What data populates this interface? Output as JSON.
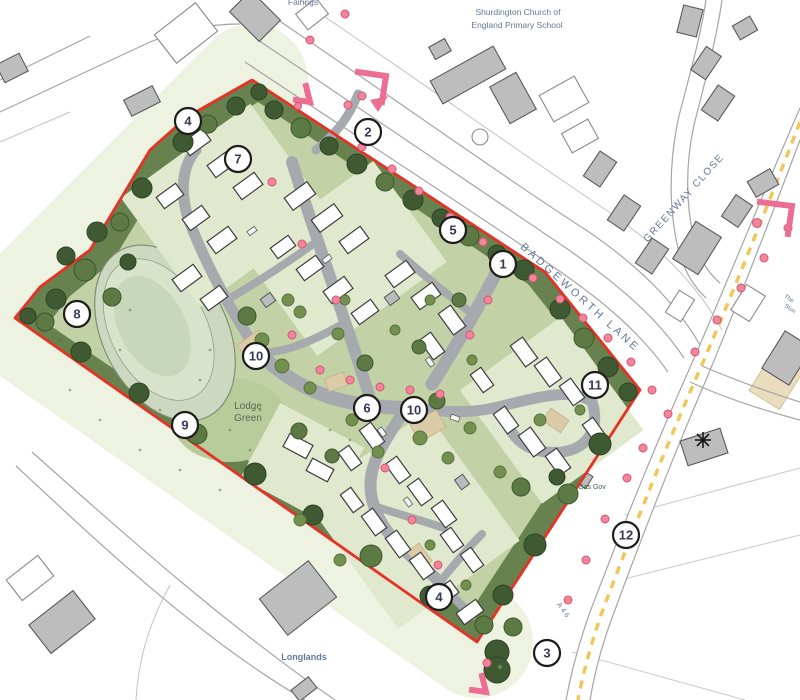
{
  "labels": {
    "school_line1": "Shurdington Church of",
    "school_line2": "England Primary School",
    "fairings": "Fairings",
    "badgeworth_lane": "BADGEWORTH LANE",
    "greenway_close": "GREENWAY CLOSE",
    "lodge_line1": "Lodge",
    "lodge_line2": "Green",
    "longlands": "Longlands",
    "gas_gov": "Gas Gov",
    "a46": "A46",
    "edge_partial_1": "The",
    "edge_partial_2": "Ston"
  },
  "colors": {
    "boundary_red": "#e63226",
    "band_green": "#67824e",
    "grass": "#c3d2a6",
    "lawn": "#b7cb9b",
    "tree_dark": "#3f5a33",
    "tree_mid": "#5d7a45",
    "tree_light": "#74904f",
    "road_gray": "#a6aaae",
    "parcel": "#e0e8cd",
    "house_stroke": "#3c3c3c",
    "building_gray": "#bdbdbd",
    "building_stroke": "#5a5a5a",
    "dot_pink": "#f2849b",
    "dot_stroke": "#d25672",
    "arrow_pink": "#ec6f93",
    "label_blue": "#64789a",
    "yellow_dash": "#f0c75a",
    "tan": "#dbcba6",
    "pond": "#ccd9c0",
    "pond_inner": "#d9e3cb",
    "wash": "#edf2e1",
    "lodge_text": "#5b6b57",
    "gas_text": "#41603f"
  },
  "markers": [
    {
      "n": "4",
      "x": 188,
      "y": 121
    },
    {
      "n": "7",
      "x": 238,
      "y": 159
    },
    {
      "n": "2",
      "x": 368,
      "y": 132
    },
    {
      "n": "5",
      "x": 453,
      "y": 230
    },
    {
      "n": "1",
      "x": 503,
      "y": 264
    },
    {
      "n": "8",
      "x": 77,
      "y": 314
    },
    {
      "n": "10",
      "x": 256,
      "y": 356
    },
    {
      "n": "6",
      "x": 367,
      "y": 408
    },
    {
      "n": "10",
      "x": 414,
      "y": 410
    },
    {
      "n": "11",
      "x": 595,
      "y": 385
    },
    {
      "n": "9",
      "x": 185,
      "y": 425
    },
    {
      "n": "12",
      "x": 626,
      "y": 535
    },
    {
      "n": "3",
      "x": 547,
      "y": 653
    },
    {
      "n": "4",
      "x": 439,
      "y": 597
    }
  ],
  "houses": [
    [
      196,
      142,
      26,
      15,
      -36
    ],
    [
      222,
      164,
      26,
      15,
      -36
    ],
    [
      248,
      186,
      26,
      15,
      -36
    ],
    [
      170,
      196,
      24,
      14,
      -36
    ],
    [
      196,
      218,
      24,
      14,
      -36
    ],
    [
      222,
      240,
      26,
      15,
      -36
    ],
    [
      187,
      278,
      26,
      15,
      -36
    ],
    [
      214,
      298,
      24,
      14,
      -36
    ],
    [
      300,
      196,
      28,
      15,
      -36
    ],
    [
      327,
      218,
      28,
      15,
      -36
    ],
    [
      354,
      240,
      26,
      15,
      -36
    ],
    [
      283,
      247,
      22,
      13,
      -36
    ],
    [
      310,
      268,
      24,
      14,
      -36
    ],
    [
      338,
      290,
      26,
      15,
      -36
    ],
    [
      365,
      312,
      24,
      14,
      -36
    ],
    [
      400,
      274,
      26,
      15,
      -36
    ],
    [
      426,
      296,
      26,
      15,
      -36
    ],
    [
      452,
      320,
      26,
      15,
      54
    ],
    [
      432,
      346,
      24,
      14,
      54
    ],
    [
      524,
      352,
      26,
      15,
      54
    ],
    [
      548,
      372,
      26,
      15,
      54
    ],
    [
      572,
      392,
      24,
      14,
      54
    ],
    [
      506,
      420,
      24,
      14,
      54
    ],
    [
      532,
      442,
      26,
      15,
      54
    ],
    [
      558,
      462,
      24,
      14,
      54
    ],
    [
      594,
      430,
      22,
      13,
      54
    ],
    [
      482,
      380,
      22,
      13,
      54
    ],
    [
      372,
      436,
      24,
      14,
      54
    ],
    [
      350,
      458,
      22,
      13,
      54
    ],
    [
      298,
      446,
      26,
      15,
      28
    ],
    [
      320,
      470,
      24,
      14,
      28
    ],
    [
      398,
      470,
      24,
      14,
      54
    ],
    [
      420,
      492,
      24,
      14,
      54
    ],
    [
      444,
      514,
      24,
      14,
      54
    ],
    [
      352,
      500,
      22,
      13,
      54
    ],
    [
      374,
      522,
      24,
      14,
      54
    ],
    [
      398,
      544,
      24,
      14,
      54
    ],
    [
      422,
      566,
      24,
      14,
      54
    ],
    [
      452,
      540,
      22,
      13,
      54
    ],
    [
      472,
      560,
      22,
      13,
      54
    ],
    [
      444,
      594,
      26,
      15,
      -36
    ],
    [
      470,
      612,
      24,
      14,
      -36
    ]
  ],
  "garages": [
    [
      268,
      300,
      12,
      10,
      -36
    ],
    [
      392,
      298,
      12,
      10,
      -36
    ],
    [
      462,
      482,
      12,
      10,
      54
    ]
  ],
  "cars": [
    [
      298,
      202,
      -36
    ],
    [
      327,
      259,
      -36
    ],
    [
      252,
      231,
      -36
    ],
    [
      430,
      362,
      54
    ],
    [
      382,
      432,
      54
    ],
    [
      408,
      502,
      54
    ],
    [
      455,
      418,
      20
    ]
  ],
  "trees": [
    [
      274,
      110,
      9,
      0
    ],
    [
      301,
      128,
      10,
      1
    ],
    [
      329,
      146,
      9,
      0
    ],
    [
      357,
      164,
      10,
      0
    ],
    [
      385,
      182,
      9,
      1
    ],
    [
      413,
      200,
      10,
      0
    ],
    [
      441,
      218,
      9,
      0
    ],
    [
      469,
      236,
      10,
      1
    ],
    [
      497,
      254,
      9,
      0
    ],
    [
      524,
      270,
      10,
      0
    ],
    [
      560,
      309,
      10,
      0
    ],
    [
      584,
      338,
      10,
      1
    ],
    [
      608,
      367,
      10,
      0
    ],
    [
      628,
      392,
      9,
      0
    ],
    [
      600,
      444,
      11,
      0
    ],
    [
      568,
      494,
      10,
      1
    ],
    [
      535,
      545,
      11,
      0
    ],
    [
      503,
      595,
      10,
      0
    ],
    [
      484,
      625,
      9,
      1
    ],
    [
      430,
      596,
      10,
      0
    ],
    [
      371,
      556,
      11,
      1
    ],
    [
      313,
      515,
      10,
      0
    ],
    [
      255,
      474,
      11,
      0
    ],
    [
      197,
      434,
      10,
      1
    ],
    [
      139,
      393,
      10,
      0
    ],
    [
      81,
      352,
      10,
      0
    ],
    [
      45,
      322,
      9,
      1
    ],
    [
      56,
      299,
      10,
      0
    ],
    [
      85,
      270,
      11,
      1
    ],
    [
      66,
      256,
      9,
      0
    ],
    [
      97,
      232,
      10,
      0
    ],
    [
      120,
      222,
      9,
      1
    ],
    [
      142,
      188,
      10,
      0
    ],
    [
      183,
      142,
      10,
      0
    ],
    [
      208,
      124,
      9,
      1
    ],
    [
      236,
      106,
      9,
      0
    ],
    [
      259,
      92,
      8,
      0
    ],
    [
      112,
      297,
      9,
      1
    ],
    [
      128,
      262,
      8,
      0
    ],
    [
      28,
      316,
      8,
      0
    ],
    [
      497,
      652,
      12,
      0
    ],
    [
      513,
      627,
      9,
      1
    ],
    [
      497,
      670,
      13,
      0
    ],
    [
      500,
      667,
      2,
      2
    ],
    [
      247,
      316,
      9,
      1
    ],
    [
      365,
      363,
      8,
      1
    ],
    [
      437,
      401,
      8,
      1
    ],
    [
      521,
      487,
      9,
      1
    ],
    [
      557,
      477,
      8,
      0
    ],
    [
      419,
      347,
      7,
      1
    ],
    [
      299,
      431,
      8,
      1
    ],
    [
      332,
      456,
      7,
      1
    ],
    [
      459,
      300,
      7,
      1
    ],
    [
      262,
      340,
      7,
      2
    ],
    [
      282,
      366,
      7,
      2
    ],
    [
      310,
      388,
      6,
      2
    ],
    [
      352,
      420,
      6,
      2
    ],
    [
      300,
      312,
      6,
      2
    ],
    [
      338,
      334,
      6,
      2
    ],
    [
      420,
      438,
      7,
      2
    ],
    [
      448,
      458,
      6,
      2
    ],
    [
      470,
      428,
      6,
      2
    ],
    [
      500,
      472,
      6,
      2
    ],
    [
      378,
      452,
      6,
      2
    ],
    [
      288,
      300,
      6,
      2
    ],
    [
      345,
      300,
      5,
      2
    ],
    [
      395,
      330,
      5,
      2
    ],
    [
      430,
      300,
      5,
      2
    ],
    [
      472,
      360,
      5,
      2
    ],
    [
      540,
      420,
      6,
      2
    ],
    [
      580,
      410,
      5,
      2
    ],
    [
      300,
      520,
      6,
      2
    ],
    [
      340,
      560,
      6,
      2
    ],
    [
      430,
      545,
      5,
      2
    ],
    [
      466,
      585,
      5,
      2
    ]
  ],
  "dots": [
    [
      345,
      14
    ],
    [
      310,
      40
    ],
    [
      348,
      105
    ],
    [
      362,
      147
    ],
    [
      392,
      169
    ],
    [
      419,
      191
    ],
    [
      450,
      217
    ],
    [
      483,
      242
    ],
    [
      533,
      278
    ],
    [
      560,
      299
    ],
    [
      583,
      318
    ],
    [
      608,
      338
    ],
    [
      631,
      362
    ],
    [
      652,
      390
    ],
    [
      788,
      228
    ],
    [
      764,
      258
    ],
    [
      741,
      288
    ],
    [
      717,
      320
    ],
    [
      695,
      352
    ],
    [
      668,
      414
    ],
    [
      643,
      448
    ],
    [
      627,
      478
    ],
    [
      605,
      519
    ],
    [
      586,
      560
    ],
    [
      568,
      600
    ],
    [
      553,
      645
    ],
    [
      487,
      663
    ],
    [
      292,
      335
    ],
    [
      320,
      370
    ],
    [
      350,
      380
    ],
    [
      380,
      387
    ],
    [
      410,
      390
    ],
    [
      440,
      394
    ],
    [
      470,
      335
    ],
    [
      488,
      300
    ],
    [
      385,
      468
    ],
    [
      412,
      520
    ],
    [
      438,
      565
    ],
    [
      272,
      182
    ],
    [
      302,
      244
    ],
    [
      336,
      300
    ]
  ],
  "specks": [
    [
      70,
      390
    ],
    [
      100,
      420
    ],
    [
      140,
      450
    ],
    [
      180,
      470
    ],
    [
      220,
      490
    ],
    [
      120,
      350
    ],
    [
      90,
      310
    ],
    [
      200,
      380
    ],
    [
      230,
      430
    ],
    [
      260,
      410
    ],
    [
      160,
      410
    ],
    [
      210,
      350
    ],
    [
      300,
      430
    ],
    [
      60,
      340
    ],
    [
      130,
      310
    ],
    [
      250,
      450
    ],
    [
      330,
      430
    ],
    [
      350,
      440
    ]
  ]
}
